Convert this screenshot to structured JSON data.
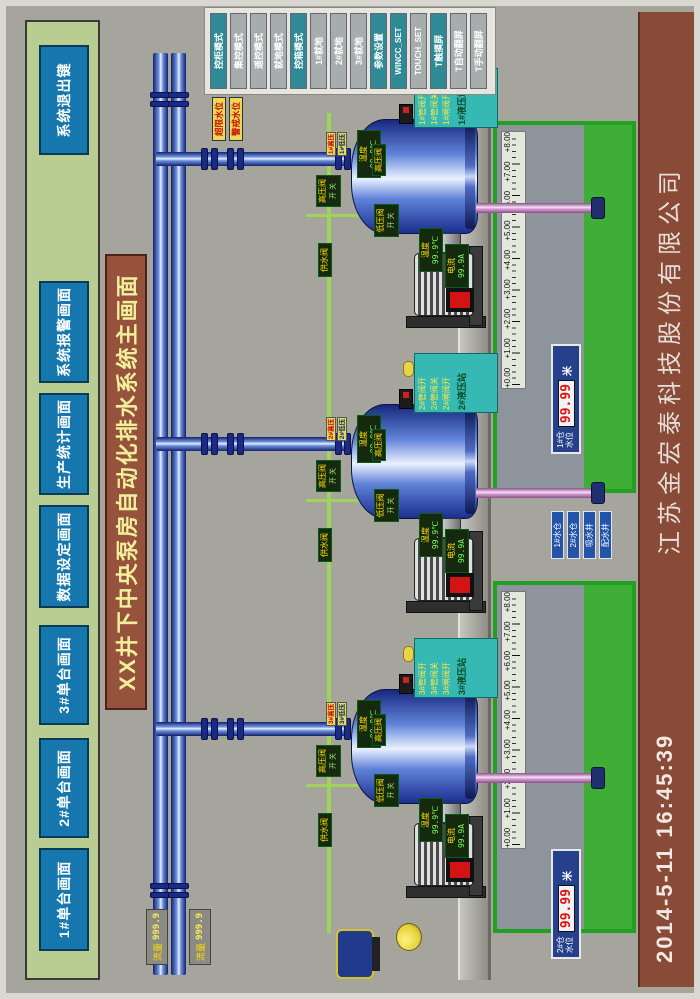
{
  "screen_title": "XX井下中央泵房自动化排水系统主画面",
  "nav": {
    "buttons": [
      "1#单台画面",
      "2#单台画面",
      "3#单台画面",
      "数据设定画面",
      "生产统计画面",
      "系统报警画面",
      "系统退出键"
    ]
  },
  "mode_panel": {
    "buttons": [
      {
        "label": "控柜模式",
        "active": true
      },
      {
        "label": "集控模式",
        "active": false
      },
      {
        "label": "遥控模式",
        "active": false
      },
      {
        "label": "就地模式",
        "active": false
      },
      {
        "label": "控箱模式",
        "active": true
      },
      {
        "label": "1#就地",
        "active": false
      },
      {
        "label": "2#就地",
        "active": false
      },
      {
        "label": "3#就地",
        "active": false
      },
      {
        "label": "参数设置",
        "active": true
      },
      {
        "label": "WINCC_SET",
        "active": true
      },
      {
        "label": "TOUCH_SET",
        "active": false
      },
      {
        "label": "T触摸屏",
        "active": true
      },
      {
        "label": "T自动翻屏",
        "active": false
      },
      {
        "label": "T手动翻屏",
        "active": false
      }
    ]
  },
  "alarm_tags": [
    "超限水位",
    "警戒水位"
  ],
  "flow_meters": [
    {
      "label": "流量",
      "value": "999.9"
    },
    {
      "label": "流量",
      "value": "999.9"
    }
  ],
  "units": [
    {
      "id": "3#",
      "pump_temp_label": "温度",
      "pump_temp_value": "99.9℃",
      "motor_current_label": "电流",
      "motor_current_value": "99.9A",
      "motor_temp_label": "温度",
      "motor_temp_value": "99.9℃",
      "pipe_valve": "高压阀",
      "hp_valve": "高压阀",
      "hp_status": "开 关",
      "lp_valve": "低压阀",
      "lp_status": "开 关",
      "supply_valve": "供水阀",
      "tag_top": "3#高压",
      "tag_bottom": "3#低压",
      "hyd_rows": [
        "3#管阀开",
        "3#管阀关",
        "3#闸阀开"
      ],
      "hyd_title": "3#液压站"
    },
    {
      "id": "2#",
      "pump_temp_label": "温度",
      "pump_temp_value": "99.9℃",
      "motor_current_label": "电流",
      "motor_current_value": "99.9A",
      "motor_temp_label": "温度",
      "motor_temp_value": "99.9℃",
      "pipe_valve": "高压阀",
      "hp_valve": "高压阀",
      "hp_status": "开 关",
      "lp_valve": "低压阀",
      "lp_status": "开 关",
      "supply_valve": "供水阀",
      "tag_top": "2#高压",
      "tag_bottom": "2#低压",
      "hyd_rows": [
        "2#管阀开",
        "2#管阀关",
        "2#闸阀开"
      ],
      "hyd_title": "2#液压站"
    },
    {
      "id": "1#",
      "pump_temp_label": "温度",
      "pump_temp_value": "99.9℃",
      "motor_current_label": "电流",
      "motor_current_value": "99.9A",
      "motor_temp_label": "温度",
      "motor_temp_value": "99.9℃",
      "pipe_valve": "高压阀",
      "hp_valve": "高压阀",
      "hp_status": "开 关",
      "lp_valve": "低压阀",
      "lp_status": "开 关",
      "supply_valve": "供水阀",
      "tag_top": "1#高压",
      "tag_bottom": "1#低压",
      "hyd_rows": [
        "1#管阀开",
        "1#管阀关",
        "1#闸阀开"
      ],
      "hyd_title": "1#液压站"
    }
  ],
  "tanks": {
    "scale_labels": [
      "+0.00",
      "+1.00",
      "+2.00",
      "+3.00",
      "+4.00",
      "+5.00",
      "+6.00",
      "+7.00",
      "+8.00"
    ],
    "readouts": [
      {
        "line1": "2#仓",
        "line2": "水位",
        "value": "99.99",
        "unit": "米"
      },
      {
        "line1": "1#仓",
        "line2": "水位",
        "value": "99.99",
        "unit": "米"
      }
    ]
  },
  "legend": [
    "1#水仓",
    "2#水仓",
    "吸水井",
    "配水井"
  ],
  "banner": {
    "datetime": "2014-5-11  16:45:39",
    "company": "江苏金宏泰科技股份有限公司"
  },
  "colors": {
    "accent_teal": "#2f8a96",
    "panel_gray": "#a7adad",
    "bar_green": "#b9cc92",
    "button_blue": "#1577ad",
    "title_brown": "#96523c",
    "banner_brown": "#8a4a38",
    "tank_green": "#22a022",
    "water_green": "#3fae36",
    "alarm_yellow": "#e8d95a",
    "value_red": "#dd1111"
  }
}
